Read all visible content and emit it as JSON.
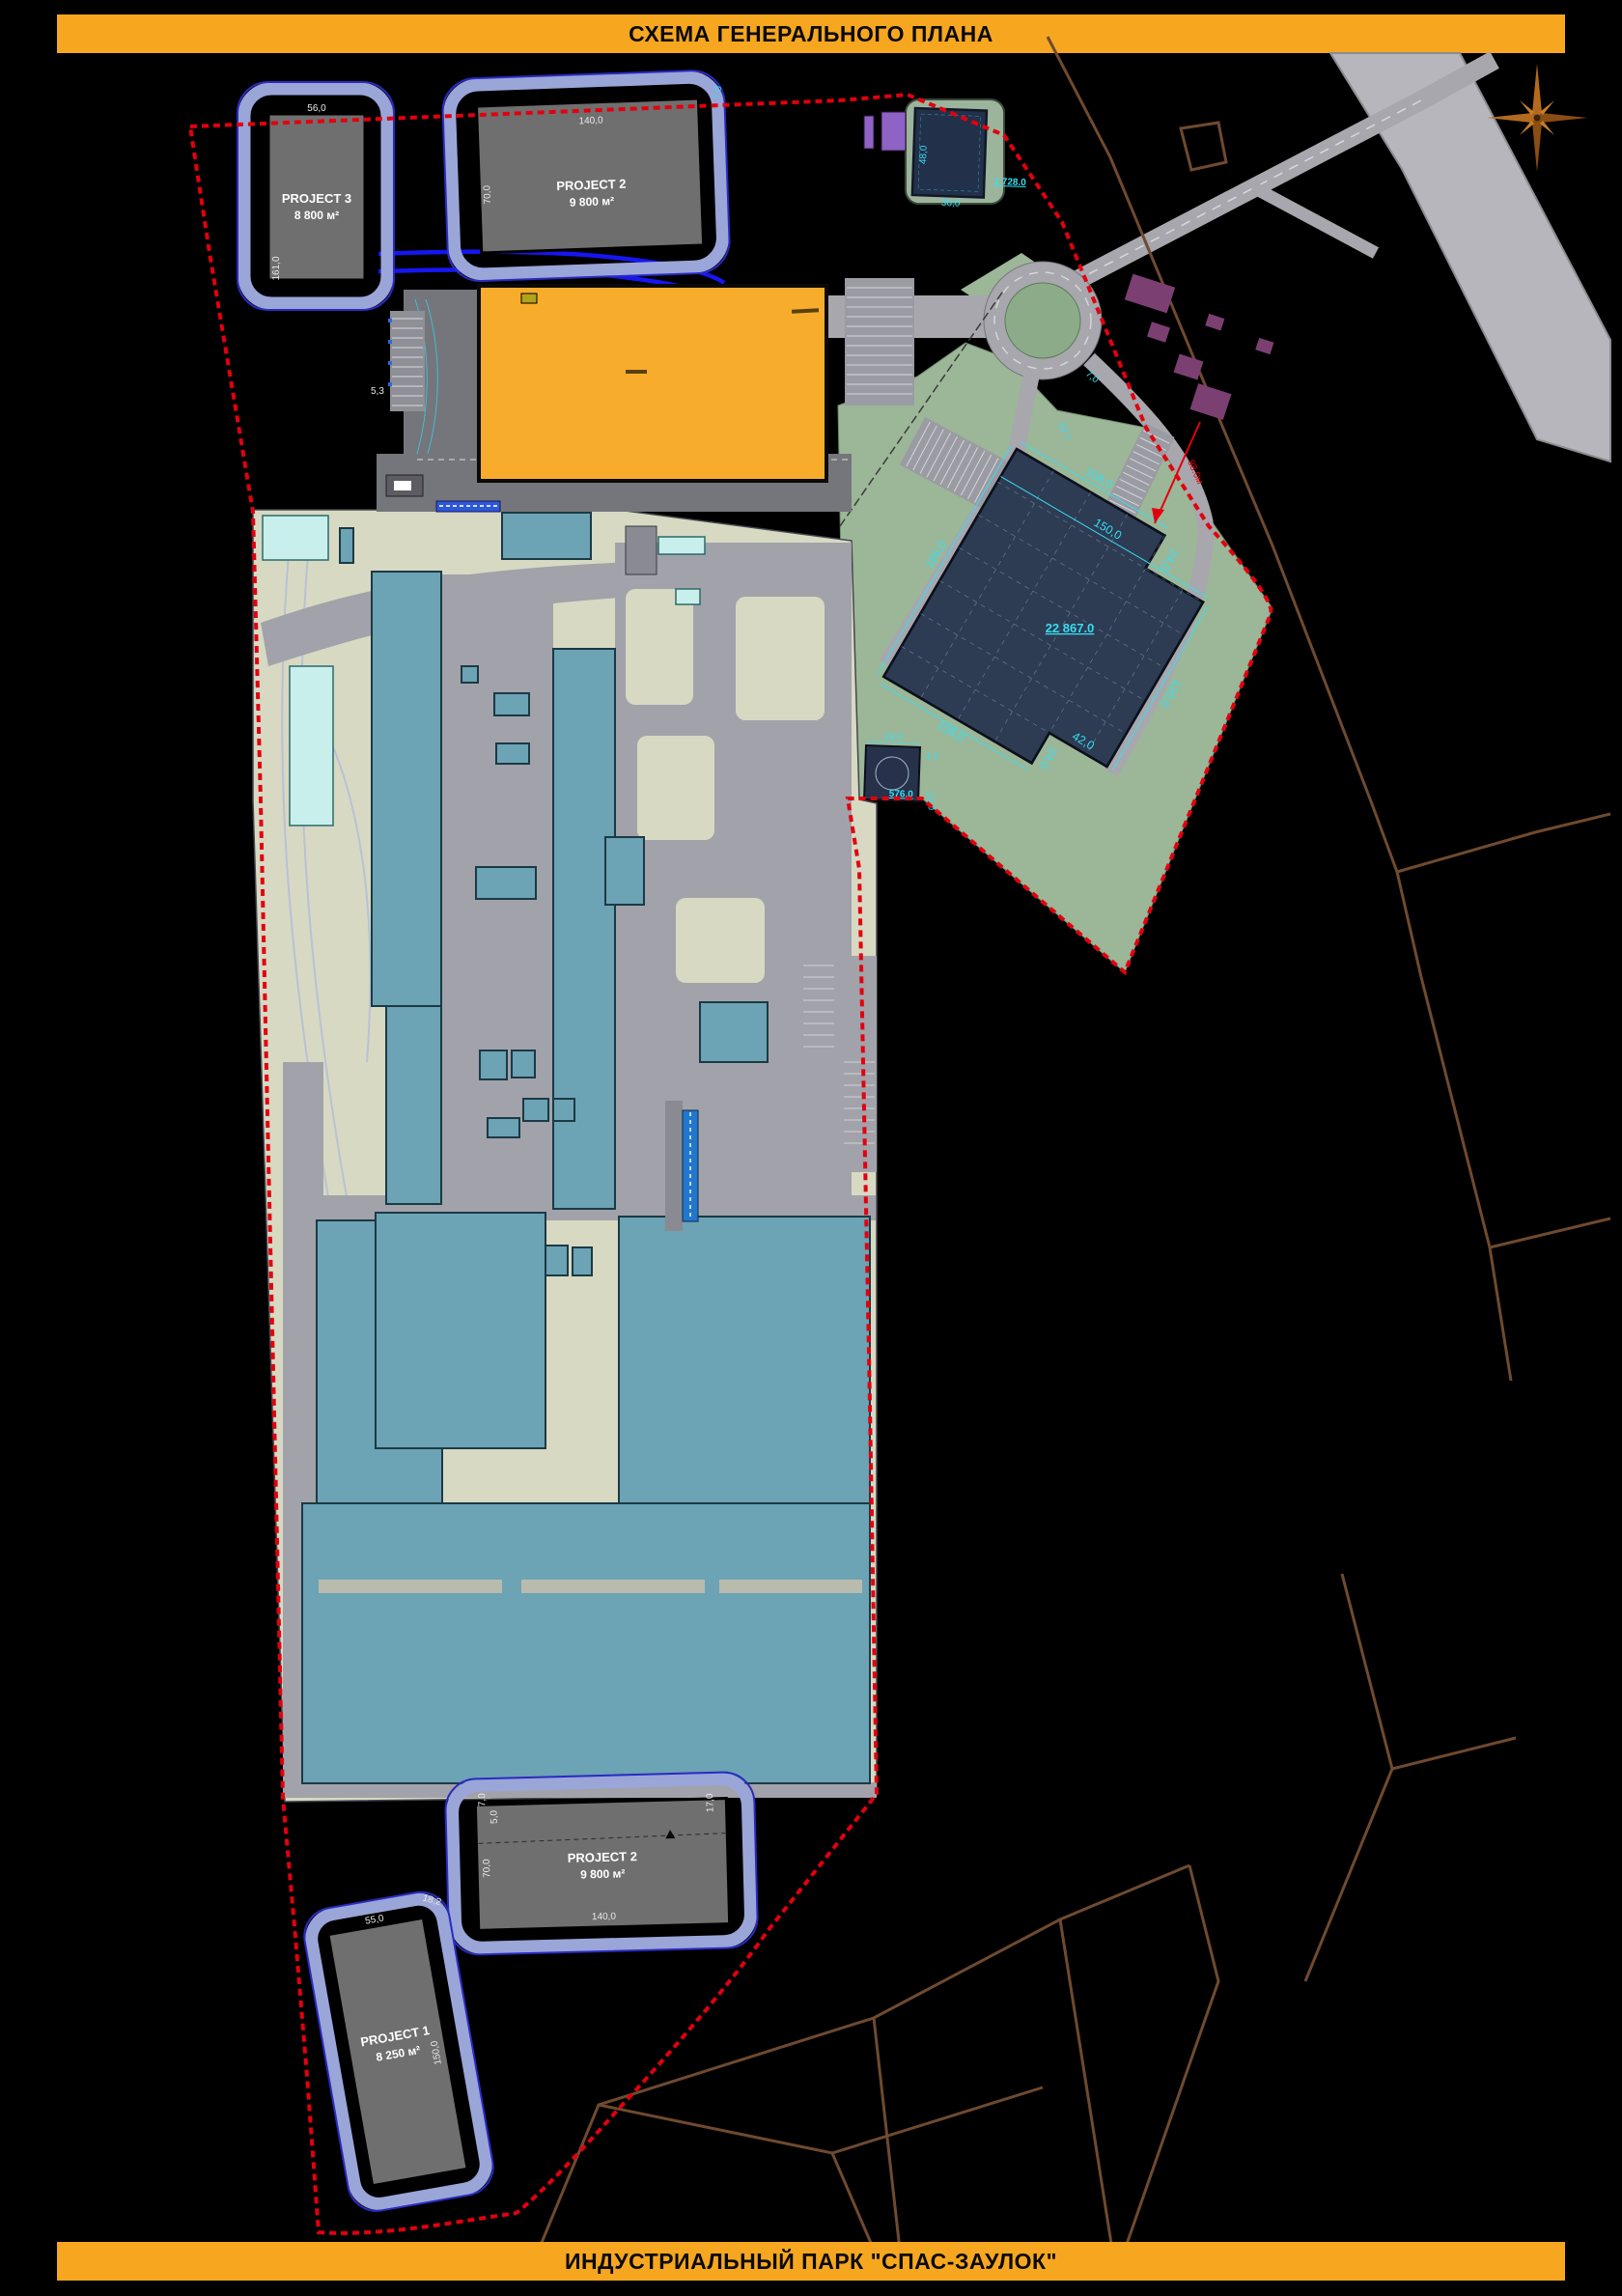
{
  "banners": {
    "top": "СХЕМА ГЕНЕРАЛЬНОГО ПЛАНА",
    "bottom": "ИНДУСТРИАЛЬНЫЙ ПАРК \"СПАС-ЗАУЛОК\""
  },
  "projects": {
    "p3": {
      "name": "PROJECT 3",
      "area": "8 800 м²",
      "dim_w": "56,0",
      "dim_h": "161,0"
    },
    "p2_top": {
      "name": "PROJECT 2",
      "area": "9 800 м²",
      "dim_w": "140,0",
      "dim_h": "70,0"
    },
    "p2_bottom": {
      "name": "PROJECT 2",
      "area": "9 800 м²",
      "dim_w": "140,0",
      "dim_h": "70,0"
    },
    "p1": {
      "name": "PROJECT 1",
      "area": "8 250 м²",
      "dim_w": "55,0",
      "dim_h": "150,0"
    }
  },
  "warehouse": {
    "area_label": "22 867.0",
    "dim_top": "108,0",
    "dim_inner": "150,0",
    "dim_notch": "24,0",
    "dim_left": "166,0",
    "dim_right": "120,0",
    "dim_bottom": "108,0",
    "dim_bottom_notch": "24,0",
    "dim_bottom_step": "42,0",
    "offset_label": "88.0м"
  },
  "checkpoint": {
    "area_label": "576.0",
    "dim": "24.0",
    "d2": "4.2",
    "d3": "10.0"
  },
  "existing_building": {
    "area_label": "1 728.0",
    "dim_w": "36,0",
    "dim_h": "48,0"
  },
  "misc_dims": {
    "d527": "52.7",
    "d70": "7,0",
    "d53": "5,3",
    "d50": "5,0",
    "d170": "17,0",
    "d182": "18,2"
  },
  "colors": {
    "banner": "#F6A71F",
    "boundary_red": "#E3000E",
    "pad_outline": "#9AA5D8",
    "project_gray": "#6F6F6F",
    "orange_building": "#F7AD2B",
    "parcel_beige": "#D7D9C3",
    "road_gray": "#A2A2AA",
    "factory_teal": "#6CA3B5",
    "pale_cyan": "#C9EFED",
    "green": "#9CB698",
    "warehouse_navy": "#2D3B53",
    "dim_cyan": "#35DFF2",
    "village_purple": "#7C3F72",
    "cadastral_brown": "#6F4A2F",
    "rail_blue": "#1616F2"
  }
}
